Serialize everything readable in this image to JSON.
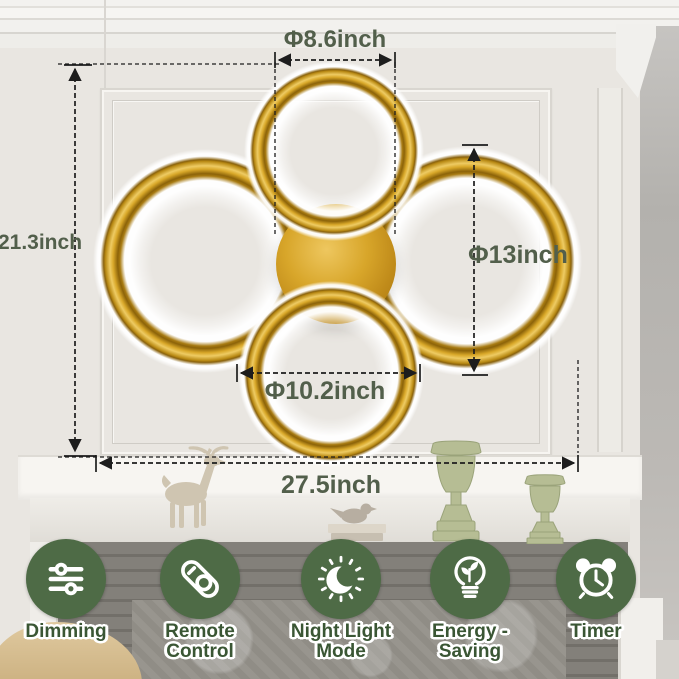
{
  "annotations": {
    "top_ring_diameter": "Φ8.6inch",
    "fixture_height": "21.3inch",
    "side_ring_diameter": "Φ13inch",
    "bottom_ring_diameter": "Φ10.2inch",
    "fixture_width": "27.5inch"
  },
  "features": [
    {
      "label": "Dimming",
      "icon": "dimmer-sliders-icon"
    },
    {
      "label": "Remote Control",
      "icon": "remote-control-icon"
    },
    {
      "label": "Night Light Mode",
      "icon": "moon-icon"
    },
    {
      "label": "Energy - Saving",
      "icon": "energy-bulb-icon"
    },
    {
      "label": "Timer",
      "icon": "alarm-clock-icon"
    }
  ],
  "colors": {
    "badge_green": "#4e6b46",
    "label_green": "#3a5634",
    "dimension_text_green": "#525f4b",
    "brass_gold": "#c8921d",
    "wall": "#e9e6e1"
  },
  "scene_objects": [
    "deer-figurine",
    "bird-figurine",
    "candlestick-vase-large",
    "candlestick-vase-small",
    "fireplace-mantel",
    "ottoman"
  ]
}
